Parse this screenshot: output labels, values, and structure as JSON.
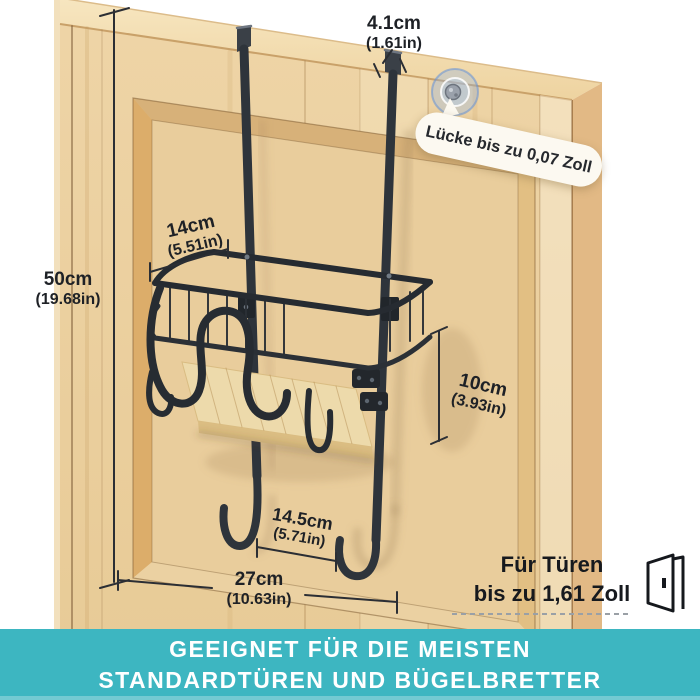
{
  "dimensions": {
    "strap_depth": {
      "value": "4.1cm",
      "inches": "(1.61in)"
    },
    "rack_height": {
      "value": "50cm",
      "inches": "(19.68in)"
    },
    "shelf_depth": {
      "value": "14cm",
      "inches": "(5.51in)"
    },
    "shelf_height": {
      "value": "10cm",
      "inches": "(3.93in)"
    },
    "hook_spacing": {
      "value": "14.5cm",
      "inches": "(5.71in)"
    },
    "rack_width": {
      "value": "27cm",
      "inches": "(10.63in)"
    }
  },
  "callout": {
    "text": "Lücke bis zu 0,07 Zoll"
  },
  "door_note": {
    "line1": "Für Türen",
    "line2": "bis zu 1,61 Zoll"
  },
  "banner": {
    "line1": "GEEIGNET FÜR DIE MEISTEN",
    "line2": "STANDARDTÜREN UND BÜGELBRETTER"
  },
  "icons": {
    "door": "open-door-icon",
    "gap": "gap-highlight-icon"
  },
  "colors": {
    "banner_teal": "#3db6c1",
    "wood_face": "#ecd2a2",
    "wood_top": "#f4e0b4",
    "wood_side": "#e2b985",
    "metal_dark": "#2e343b",
    "text_dark": "#1e2126",
    "callout_bg": "#fcf9f1",
    "gap_highlight_blue": "#7aa8e0"
  }
}
